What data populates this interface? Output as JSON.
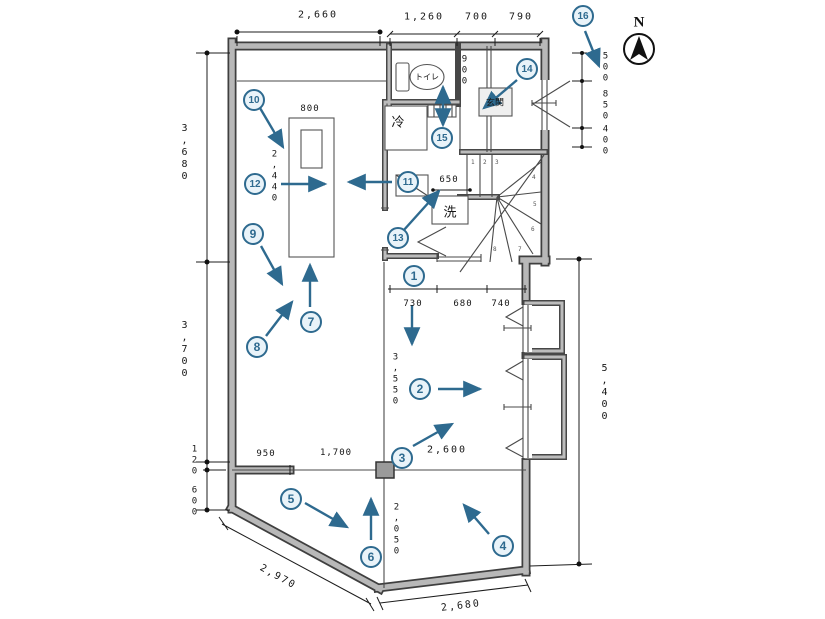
{
  "colors": {
    "wall_edge": "#3f3f3f",
    "wall_fill": "#b8b8b8",
    "accent": "#2e6a8f",
    "marker_fill": "#e9f3f9",
    "dim_text": "#161616"
  },
  "compass": {
    "label": "N"
  },
  "labels": {
    "toilet": "トイレ",
    "fridge": "冷",
    "washer": "洗",
    "entrance": "玄関"
  },
  "markers": [
    "1",
    "2",
    "3",
    "4",
    "5",
    "6",
    "7",
    "8",
    "9",
    "10",
    "11",
    "12",
    "13",
    "14",
    "15",
    "16"
  ],
  "stairs": {
    "steps": [
      "1",
      "2",
      "3",
      "4",
      "5",
      "6",
      "7",
      "8"
    ]
  },
  "dimensions": {
    "top_main": "2,660",
    "top_a": "1,260",
    "top_b": "700",
    "top_c": "790",
    "entry_a": "500",
    "entry_b": "850",
    "entry_c": "400",
    "left_upper": "3,680",
    "left_mid": "3,700",
    "left_small": "120",
    "left_lower": "600",
    "counter_width": "800",
    "counter_length": "2,440",
    "toilet_depth": "900",
    "washer_width": "650",
    "hall_a": "730",
    "hall_b": "680",
    "hall_c": "740",
    "room2_height": "3,550",
    "room2_diag": "2,600",
    "right_total": "5,400",
    "bottom_a": "950",
    "bottom_b": "1,700",
    "bottom_height": "2,050",
    "diag_left": "2,970",
    "diag_bottom": "2,680"
  }
}
